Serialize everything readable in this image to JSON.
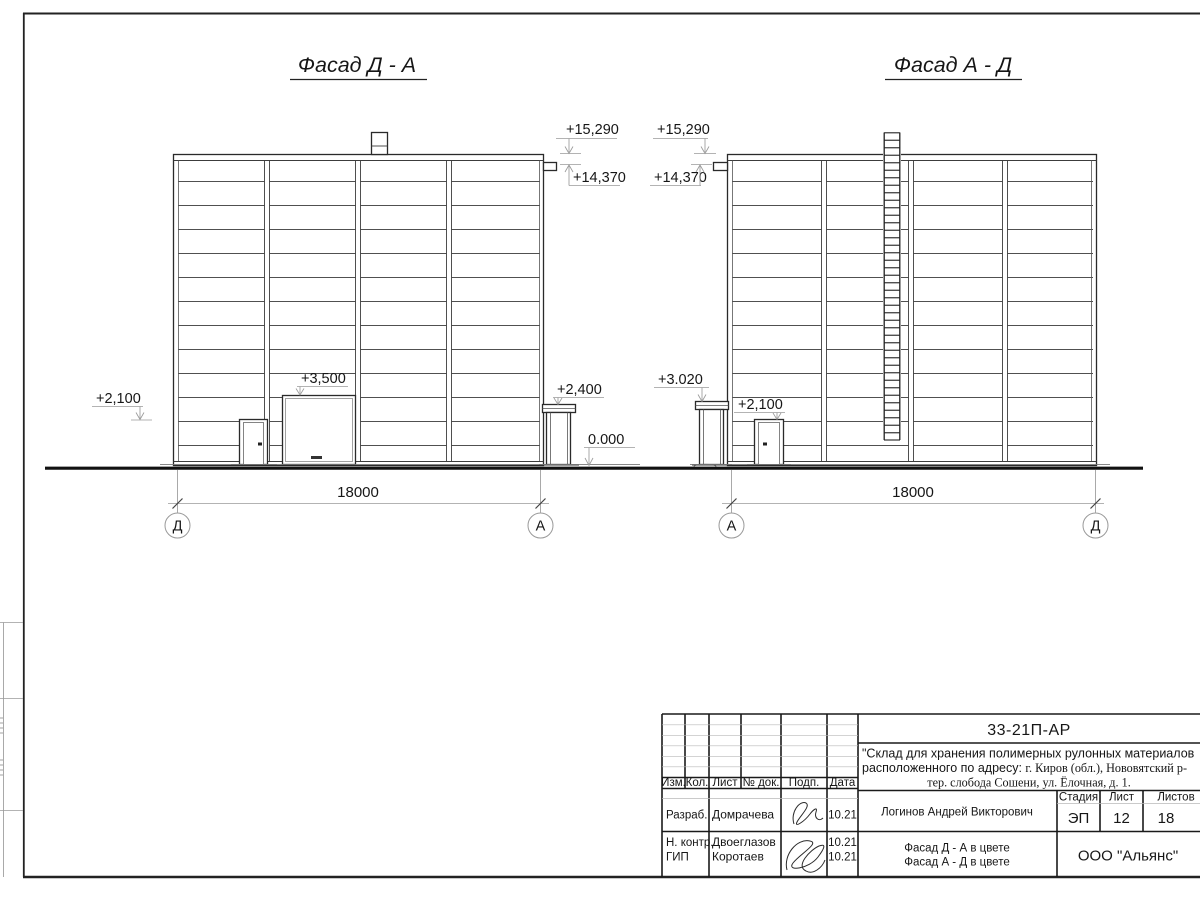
{
  "left_facade": {
    "title": "Фасад Д - А",
    "elev_parapet": "+15,290",
    "elev_eave": "+14,370",
    "elev_door": "+2,100",
    "elev_gate": "+3,500",
    "elev_entry_canopy": "+2,400",
    "elev_ground": "0.000",
    "dim": "18000",
    "axis_left": "Д",
    "axis_right": "А"
  },
  "right_facade": {
    "title": "Фасад А - Д",
    "elev_parapet": "+15,290",
    "elev_eave": "+14,370",
    "elev_entry_canopy": "+3.020",
    "elev_door": "+2,100",
    "dim": "18000",
    "axis_left": "А",
    "axis_right": "Д"
  },
  "title_block": {
    "doc_number": "33-21П-АР",
    "project_line1": "\"Склад для хранения полимерных рулонных материалов",
    "project_line2_sans": "расположенного по адресу: ",
    "project_line2_serif": "г. Киров (обл.), Нововятский р-",
    "project_line3": "тер. слобода Сошени, ул. Ёлочная, д. 1.",
    "col_izm": "Изм.",
    "col_kol": "Кол.",
    "col_list": "Лист",
    "col_doc": "№ док.",
    "col_podp": "Подп.",
    "col_data": "Дата",
    "col_stadia": "Стадия",
    "col_sheet": "Лист",
    "col_sheets": "Листов",
    "stadia_value": "ЭП",
    "sheet_value": "12",
    "sheets_value": "18",
    "roles": [
      {
        "role": "Разраб.",
        "name": "Домрачева",
        "date": "10.21"
      },
      {
        "role": "Н. контр.",
        "name": "Двоеглазов",
        "date": "10.21"
      },
      {
        "role": "ГИП",
        "name": "Коротаев",
        "date": "10.21"
      }
    ],
    "chief_name": "Логинов Андрей Викторович",
    "sheet_title_line1": "Фасад Д - А в цвете",
    "sheet_title_line2": "Фасад А - Д в цвете",
    "company": "ООО \"Альянс\""
  }
}
